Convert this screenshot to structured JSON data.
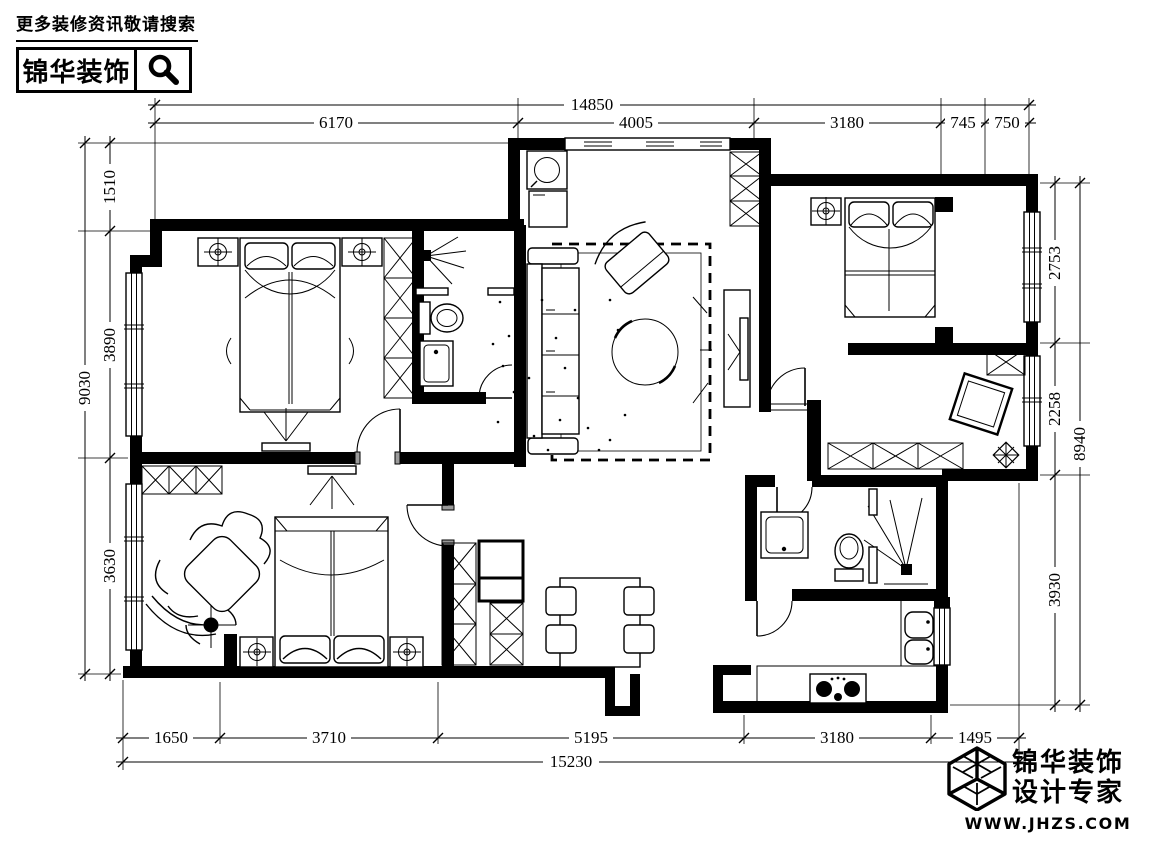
{
  "header": {
    "tagline": "更多装修资讯敬请搜索",
    "brand": "锦华装饰",
    "search_icon": "magnifier"
  },
  "dims": {
    "top": {
      "overall": "14850",
      "segments": [
        "6170",
        "4005",
        "3180",
        "745",
        "750"
      ]
    },
    "bottom": {
      "overall": "15230",
      "segments": [
        "1650",
        "3710",
        "5195",
        "3180",
        "1495"
      ]
    },
    "left": {
      "overall": "9030",
      "segments": [
        "1510",
        "3890",
        "3630"
      ]
    },
    "right": {
      "overall": "8940",
      "segments": [
        "2753",
        "2258",
        "3930"
      ]
    }
  },
  "footer": {
    "brand_line1": "锦华装饰",
    "brand_line2": "设计专家",
    "website": "WWW.JHZS.COM",
    "cube_icon": "isometric-cube-logo"
  },
  "colors": {
    "ink": "#000000",
    "paper": "#ffffff",
    "jamb_gray": "#9a9a9a"
  }
}
